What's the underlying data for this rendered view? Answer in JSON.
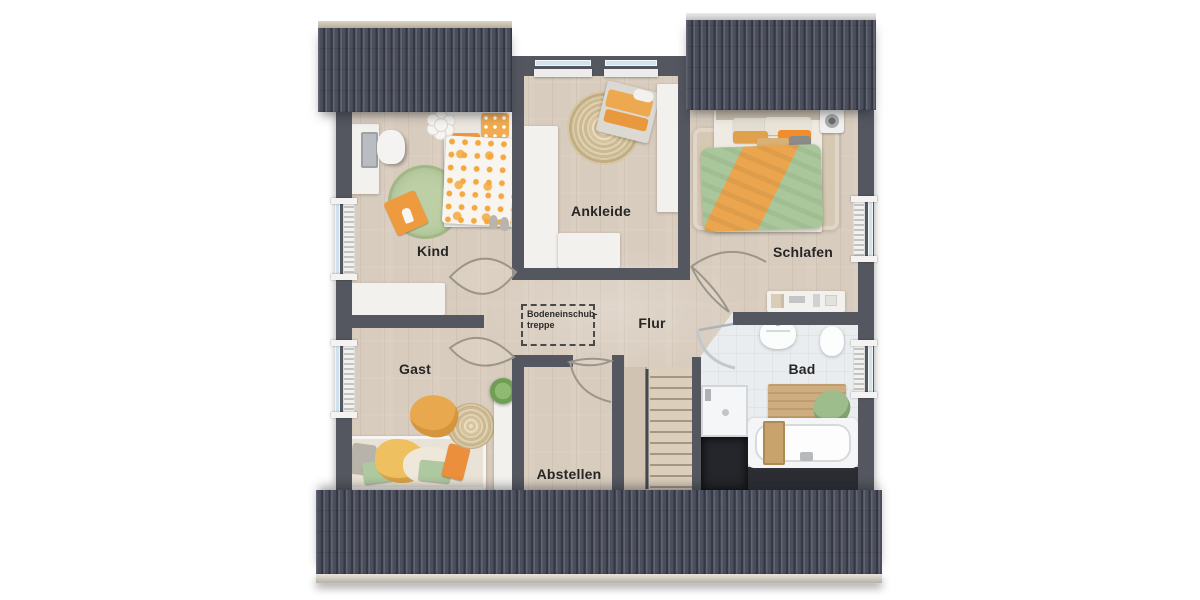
{
  "floorplan": {
    "rooms": {
      "kind": "Kind",
      "ankleide": "Ankleide",
      "schlafen": "Schlafen",
      "flur": "Flur",
      "gast": "Gast",
      "bad": "Bad",
      "abstellen": "Abstellen"
    },
    "attic_hatch": {
      "line1": "Bodeneinschub-",
      "line2": "treppe"
    },
    "fixtures": [
      "child-bed",
      "desk",
      "desk-chair",
      "round-rug",
      "floor-cushion",
      "wardrobe-l-shape",
      "wardrobe",
      "bench",
      "jute-rug",
      "double-bed",
      "bedside-rug",
      "dresser",
      "daybed",
      "potted-plant",
      "shelf-column",
      "staircase",
      "stair-railing",
      "shower",
      "sink",
      "toilet",
      "bathtub",
      "bath-mat",
      "towel",
      "radiator",
      "window",
      "attic-hatch",
      "roof"
    ],
    "colors": {
      "roof": "#4b4f5d",
      "wall": "#54575f",
      "wood_floor": "#d8ccbe",
      "tile_floor": "#eaedef",
      "accent_orange": "#ef9e45",
      "accent_green": "#a9c79b",
      "furniture_white": "#f2f1ee",
      "window_glass": "#cfe3ee",
      "background": "#ffffff"
    }
  }
}
